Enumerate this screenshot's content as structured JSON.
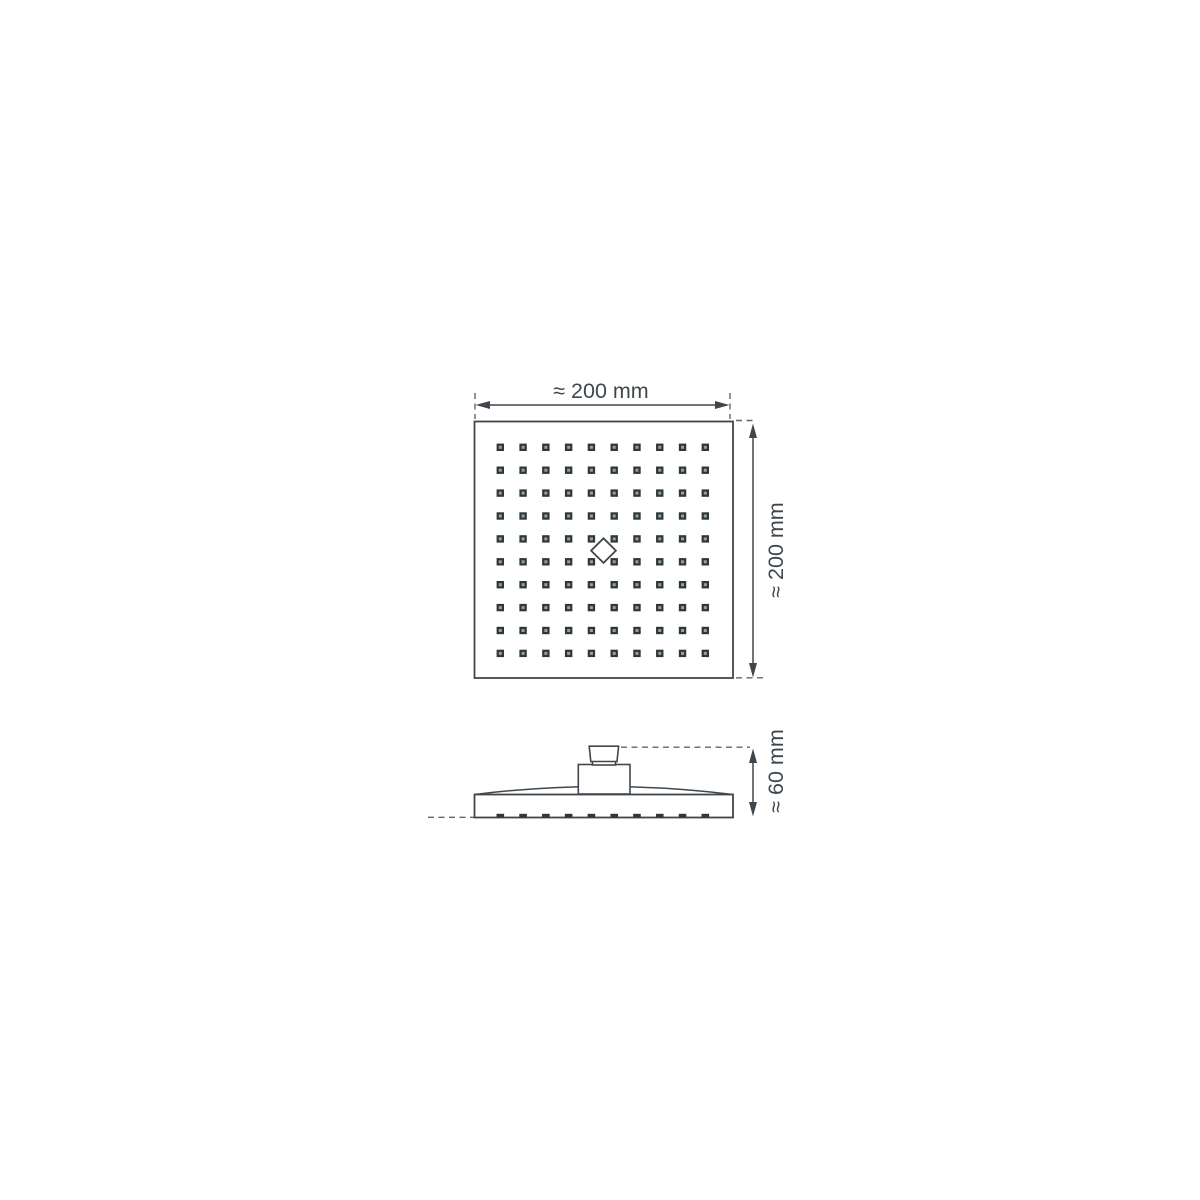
{
  "labels": {
    "width": "≈ 200 mm",
    "height": "≈ 200 mm",
    "depth": "≈ 60 mm"
  },
  "dimensions_mm": {
    "width": 200,
    "height": 200,
    "depth": 60
  },
  "colors": {
    "background": "#ffffff",
    "line": "#40474c",
    "dashed_line": "#60676c",
    "nozzle_fill": "#2e373b",
    "nozzle_center": "#97a0a6",
    "text": "#40474c"
  },
  "top_view": {
    "shape": "square",
    "nozzle_rows": 10,
    "nozzle_cols": 10,
    "center_logo": "diamond"
  },
  "side_view": {
    "bottom_tick_count": 10,
    "connector_parts": 2
  },
  "geometry": {
    "top_grid": {
      "rows": 10,
      "cols": 10,
      "x0": 500.3,
      "y0": 447.3,
      "dx": 22.78,
      "dy": 22.9,
      "size": 7.4,
      "center_size": 3.0
    },
    "side_ticks": {
      "count": 10,
      "x0": 500.3,
      "dx": 22.78,
      "y": 813.8,
      "w": 7.6,
      "h": 3.6
    }
  }
}
